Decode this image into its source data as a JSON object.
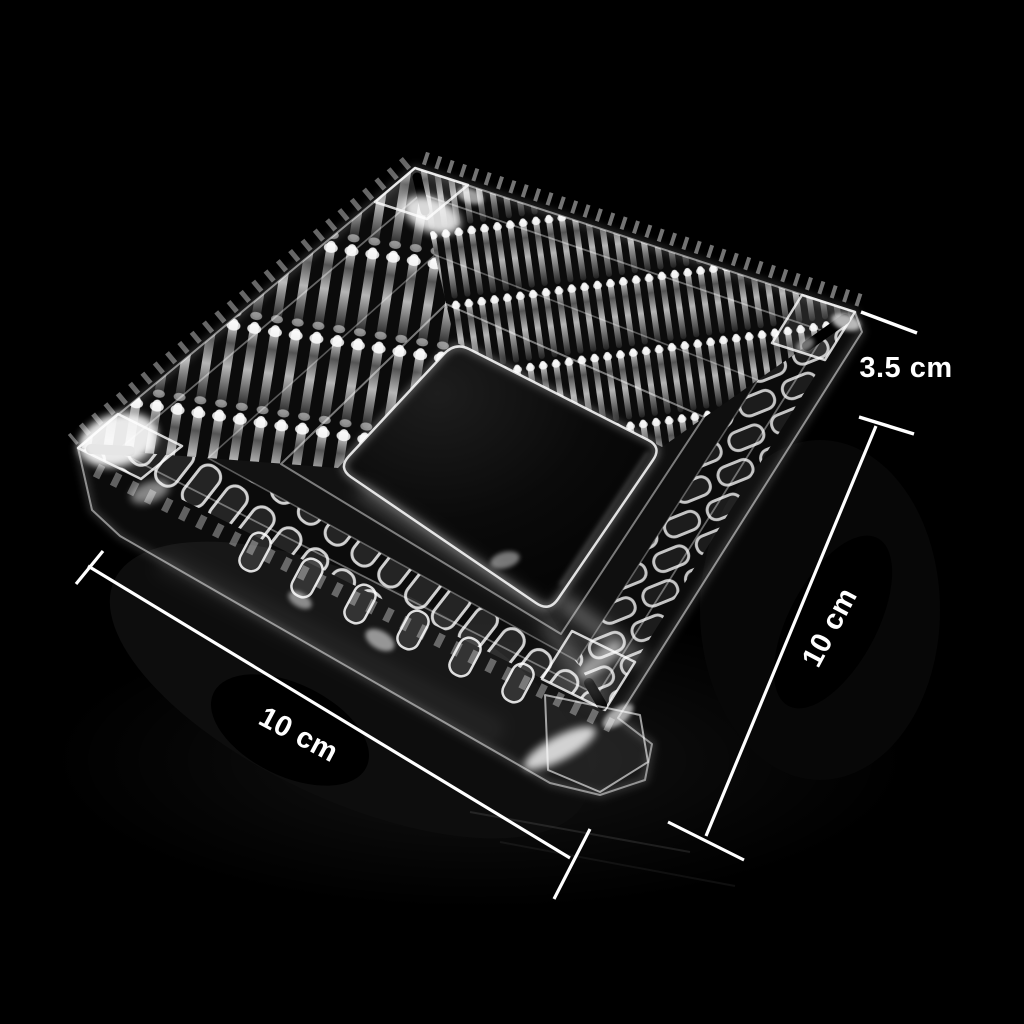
{
  "scene": {
    "background_color": "#000000",
    "annotation_color": "#ffffff",
    "subject": "square-crystal-glass-ashtray"
  },
  "annotations": {
    "height": {
      "label": "3.5 cm"
    },
    "side_right": {
      "label": "10 cm"
    },
    "side_bottom": {
      "label": "10 cm"
    }
  }
}
